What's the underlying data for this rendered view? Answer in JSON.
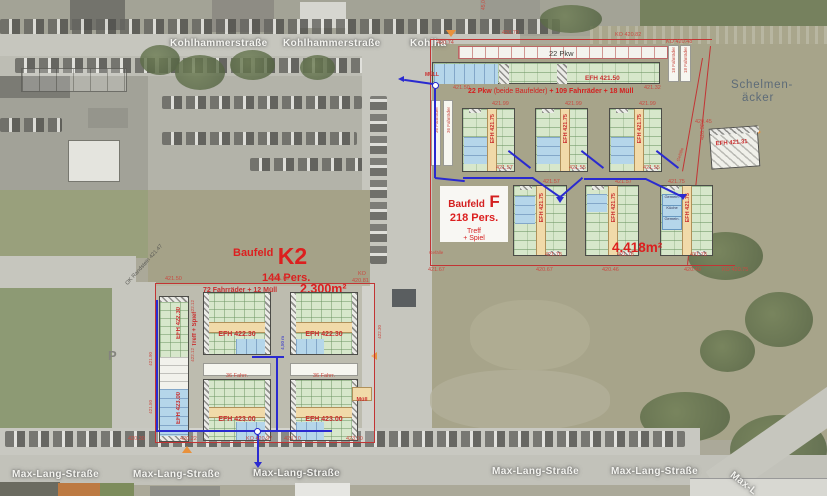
{
  "streets": {
    "kohlhammer1": "Kohlhammerstraße",
    "kohlhammer2": "Kohlhammerstraße",
    "kohlhammer3": "Kohlha",
    "maxlang1": "Max-Lang-Straße",
    "maxlang2": "Max-Lang-Straße",
    "maxlang3": "Max-Lang-Straße",
    "maxlang4": "Max-Lang-Straße",
    "maxlang5": "Max-Lang-Straße",
    "maxlang6": "Max-L",
    "parking": "P",
    "curb": "OK Randstein 421.47"
  },
  "district": {
    "line1": "Schelmen-",
    "line2": "äcker"
  },
  "f": {
    "title": "Baufeld",
    "letter": "F",
    "persons": "218 Pers.",
    "treff": "Treff",
    "spiel": "+ Spiel",
    "area": "4.418m²",
    "pkw": "22 Pkw",
    "bike18a": "18 Fahrräder",
    "bike18b": "18 Fahrräder",
    "bike36a": "36 Fahrräder",
    "bike36b": "36 Fahrräder",
    "muell": "MÜLL",
    "sum1": "22 Pkw",
    "sum2": " (beide Baufelder) ",
    "sum3": "+ 109 Fahrräder + 18 Müll",
    "rowA": {
      "label": "EFH 421.50",
      "left": "421.50",
      "right": "421.32"
    },
    "mid": {
      "l1": "EFH 421.75",
      "l2": "EFH 421.75",
      "l3": "EFH 421.75",
      "t1": "421.99",
      "t2": "421.99",
      "t3": "421.99",
      "b1": "421.57",
      "b2": "421.55",
      "b3": "421.55"
    },
    "bot": {
      "l1": "EFH 421.75",
      "l2": "EFH 421.75",
      "l3": "EFH 421.75",
      "t1": "421.57",
      "t2": "421.57",
      "t3": "421.75",
      "b1": "421.78",
      "b2": "421.78",
      "b3": "421.78",
      "c1": "Gemein.",
      "c2": "Küche",
      "c3": "Gemein."
    },
    "gef1": "Gefälle",
    "gef2": "Gefälle",
    "dim": "45,00",
    "n1": "420.74",
    "n2": "420.70",
    "n3": "KO 420.82",
    "n4": "KO 420.48",
    "s1": "421.67",
    "s2": "420.67",
    "s3": "420.46",
    "s4": "420.40",
    "s5": "KO 420.75",
    "small": {
      "label": "EFH 421.31",
      "a": "420.45",
      "b": "420.32"
    }
  },
  "k2": {
    "title": "Baufeld",
    "letter": "K2",
    "persons": "144 Pers.",
    "bikes": "72 Fahrräder + 12 Müll",
    "area": "2.300m²",
    "treff": "Treff + Spiel",
    "bike1": "36 Fahrr.",
    "bike2": "36 Fahrr.",
    "muell": "Müll",
    "r1a": "EFH 422.30",
    "r1b": "EFH 422.30",
    "r1c": "EFH 422.30",
    "r2a": "EFH 423.00",
    "r2b": "EFH 423.00",
    "r2c": "EFH 423.00",
    "t1": "421.50",
    "t2": "421.66",
    "ko": "KO",
    "ko2": "420.81",
    "v1": "422.12",
    "v2": "422.12",
    "v3": "421.90",
    "v4": "421.50",
    "v5": "422.30",
    "alley": "4,50 m",
    "b1": "420.30",
    "b2": "420.22",
    "b3": "KO 420.97",
    "b4": "423.10",
    "b5": "423.00"
  }
}
